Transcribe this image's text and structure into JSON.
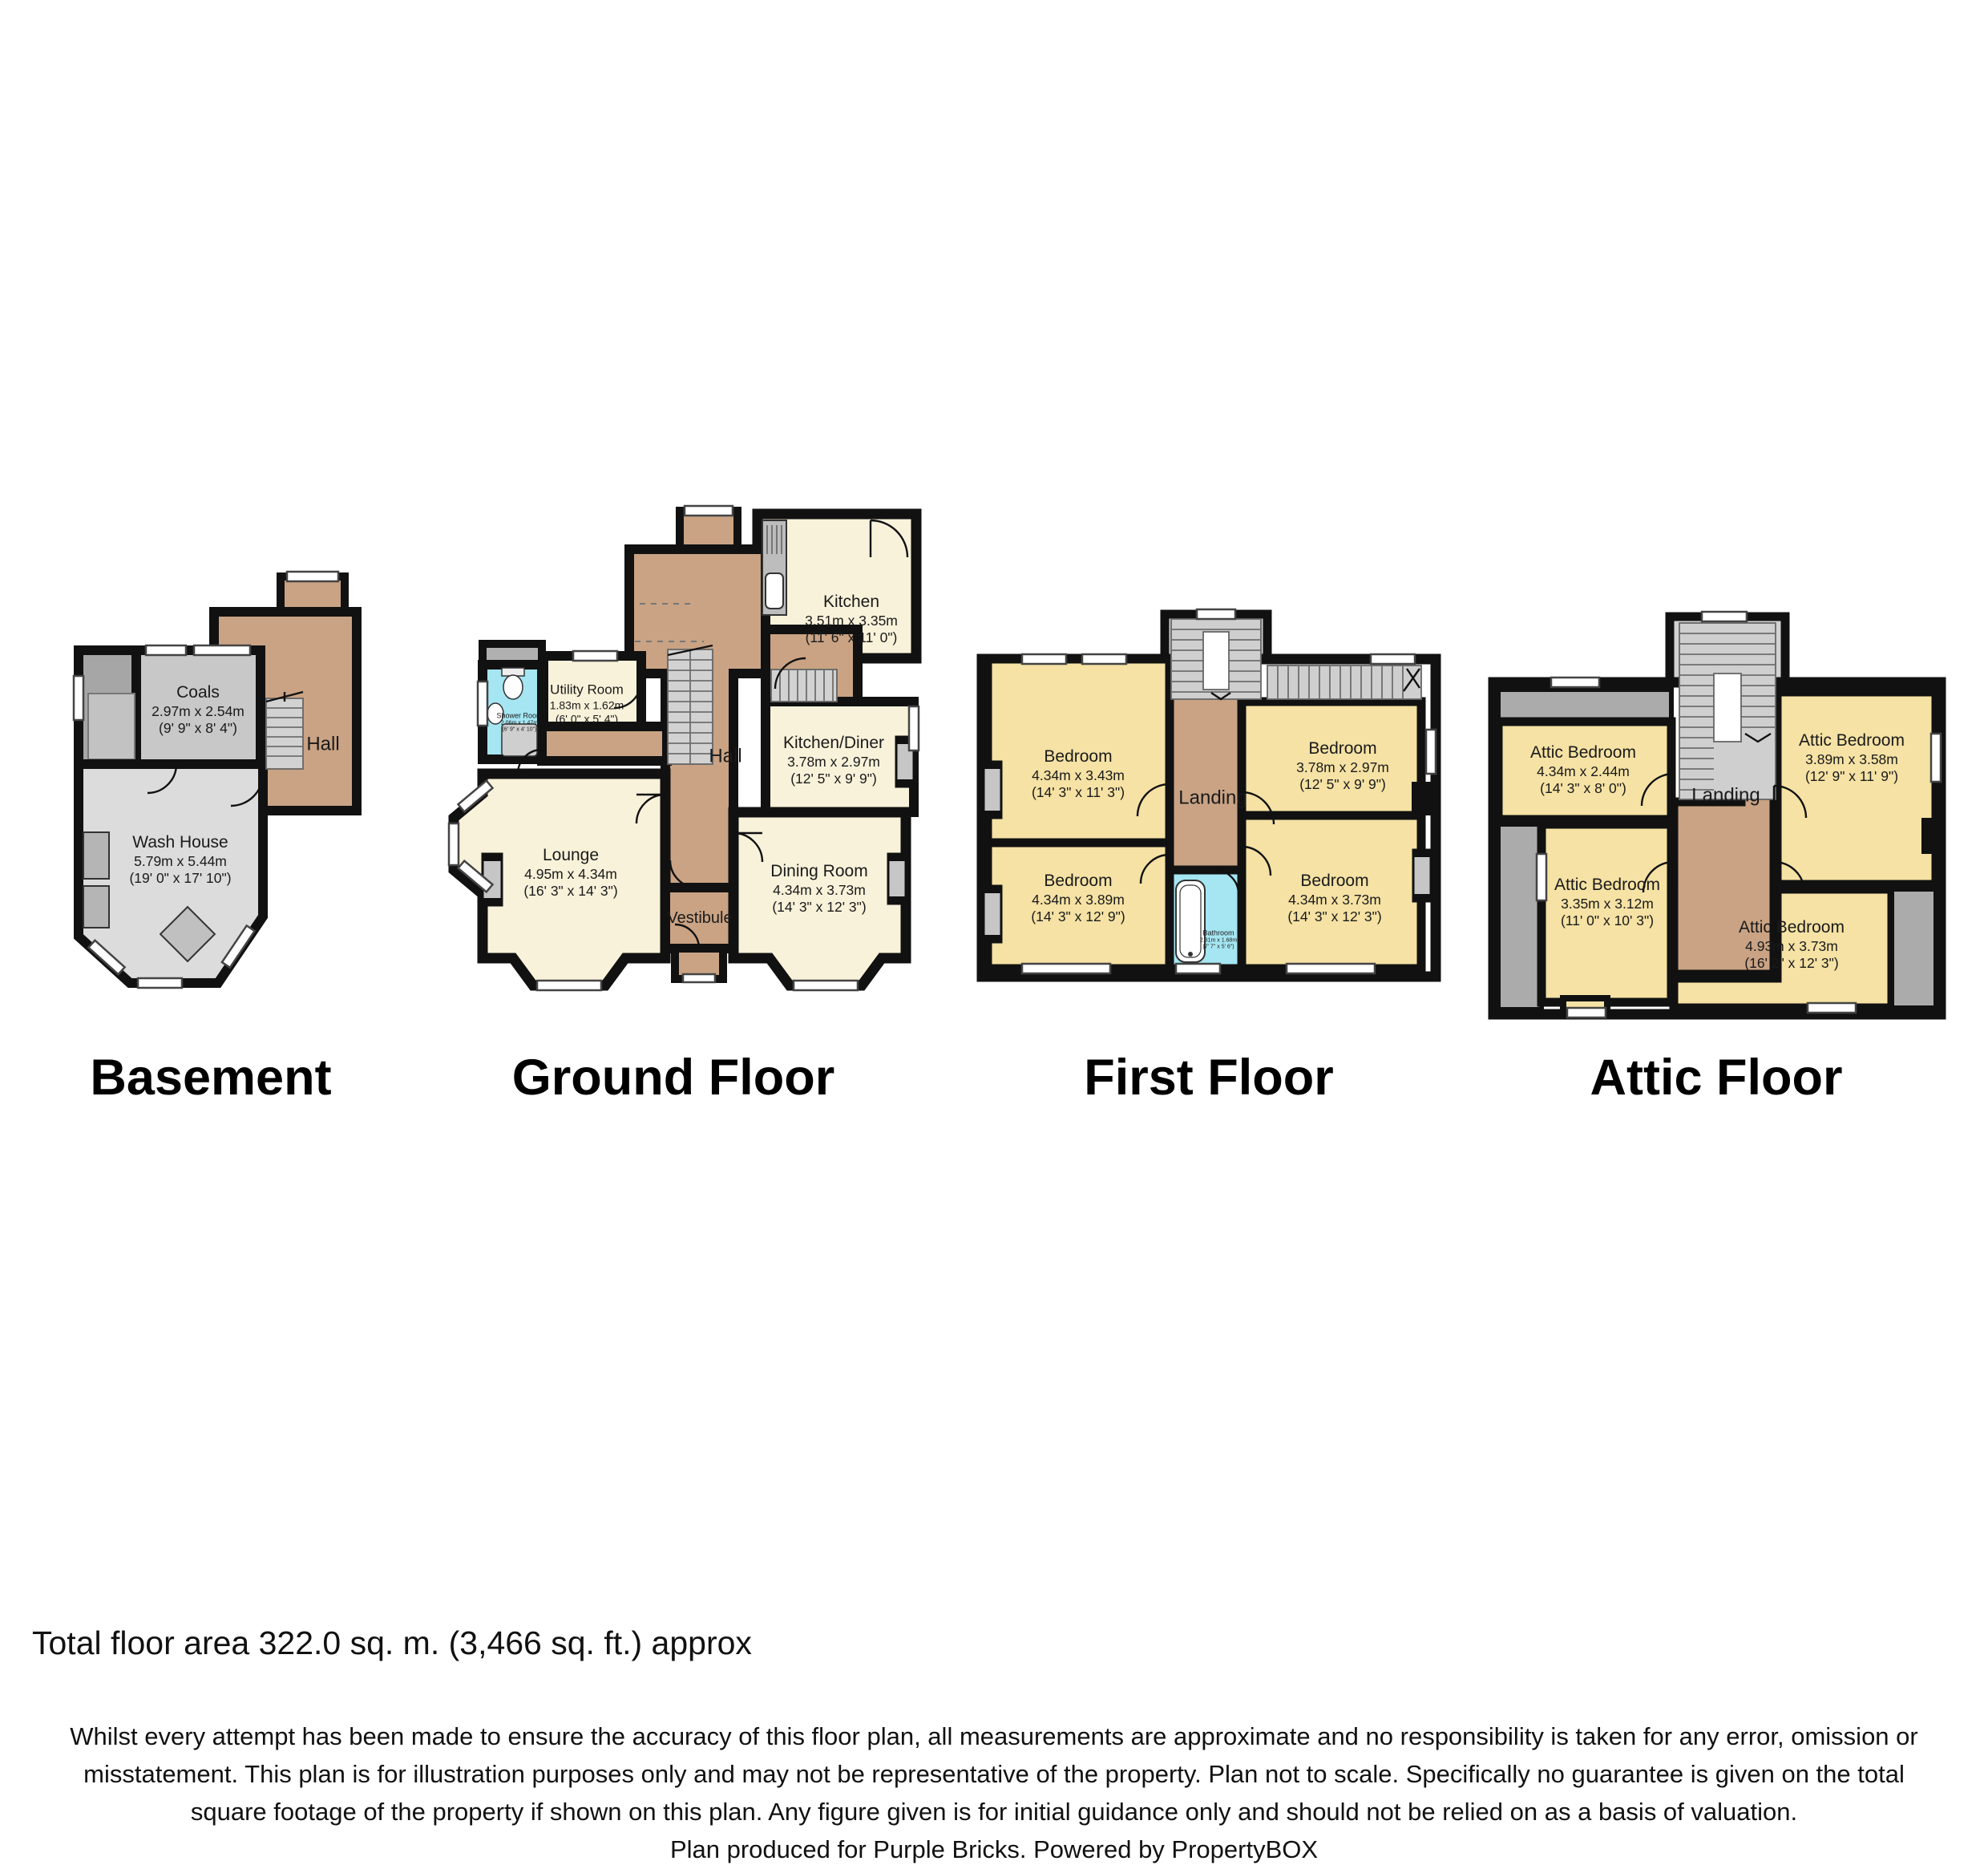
{
  "page": {
    "total_area": "Total floor area 322.0 sq. m. (3,466 sq. ft.) approx",
    "disclaimer_lines": [
      "Whilst every attempt has been made to ensure the accuracy of this floor plan, all measurements are approximate and no responsibility is taken for any error, omission or",
      "misstatement. This plan is for illustration purposes only and may not be representative of the property. Plan not to scale. Specifically no guarantee is given on the total",
      "square footage of the property if shown on this plan. Any figure given is for initial guidance only and should not be relied on as a basis of valuation.",
      "Plan produced for Purple Bricks. Powered by PropertyBOX"
    ]
  },
  "colors": {
    "wall": "#111111",
    "hall_tan": "#c9a384",
    "room_cream": "#f8f2da",
    "bedroom_yellow": "#f5e2a4",
    "bath_blue": "#a5e6f2",
    "gray_light": "#dcdcdc",
    "gray_mid": "#c6c6c6",
    "gray_dark": "#a9a9a9",
    "stairs_gray": "#d2d2d2"
  },
  "floors": {
    "basement": {
      "title": "Basement",
      "rooms": {
        "coals": {
          "name": "Coals",
          "m": "2.97m x 2.54m",
          "ft": "(9' 9\" x 8' 4\")"
        },
        "hall": {
          "name": "Hall"
        },
        "wash_house": {
          "name": "Wash House",
          "m": "5.79m x 5.44m",
          "ft": "(19' 0\" x 17' 10\")"
        }
      }
    },
    "ground": {
      "title": "Ground Floor",
      "rooms": {
        "kitchen": {
          "name": "Kitchen",
          "m": "3.51m x 3.35m",
          "ft": "(11' 6\" x 11' 0\")"
        },
        "utility": {
          "name": "Utility Room",
          "m": "1.83m x 1.62m",
          "ft": "(6' 0\" x 5' 4\")"
        },
        "shower": {
          "name": "Shower Room",
          "m": "2.06m x 1.47m",
          "ft": "(6' 9\" x 4' 10\")"
        },
        "hall": {
          "name": "Hall"
        },
        "kitchen_diner": {
          "name": "Kitchen/Diner",
          "m": "3.78m x 2.97m",
          "ft": "(12' 5\" x 9' 9\")"
        },
        "lounge": {
          "name": "Lounge",
          "m": "4.95m x 4.34m",
          "ft": "(16' 3\" x 14' 3\")"
        },
        "dining": {
          "name": "Dining Room",
          "m": "4.34m x 3.73m",
          "ft": "(14' 3\" x 12' 3\")"
        },
        "vestibule": {
          "name": "Vestibule"
        }
      }
    },
    "first": {
      "title": "First Floor",
      "rooms": {
        "bed_tl": {
          "name": "Bedroom",
          "m": "4.34m x 3.43m",
          "ft": "(14' 3\" x 11' 3\")"
        },
        "bed_tr": {
          "name": "Bedroom",
          "m": "3.78m x 2.97m",
          "ft": "(12' 5\" x 9' 9\")"
        },
        "landing": {
          "name": "Landing"
        },
        "bed_bl": {
          "name": "Bedroom",
          "m": "4.34m x 3.89m",
          "ft": "(14' 3\" x 12' 9\")"
        },
        "bathroom": {
          "name": "Bathroom",
          "m": "2.31m x 1.68m",
          "ft": "(7' 7\" x 5' 6\")"
        },
        "bed_br": {
          "name": "Bedroom",
          "m": "4.34m x 3.73m",
          "ft": "(14' 3\" x 12' 3\")"
        }
      }
    },
    "attic": {
      "title": "Attic Floor",
      "rooms": {
        "attic_tl": {
          "name": "Attic Bedroom",
          "m": "4.34m x 2.44m",
          "ft": "(14' 3\" x 8' 0\")"
        },
        "attic_tr": {
          "name": "Attic Bedroom",
          "m": "3.89m x 3.58m",
          "ft": "(12' 9\" x 11' 9\")"
        },
        "landing": {
          "name": "Landing"
        },
        "attic_bl": {
          "name": "Attic Bedroom",
          "m": "3.35m x 3.12m",
          "ft": "(11' 0\" x 10' 3\")"
        },
        "attic_br": {
          "name": "Attic Bedroom",
          "m": "4.93m x 3.73m",
          "ft": "(16' 2\" x 12' 3\")"
        }
      }
    }
  }
}
